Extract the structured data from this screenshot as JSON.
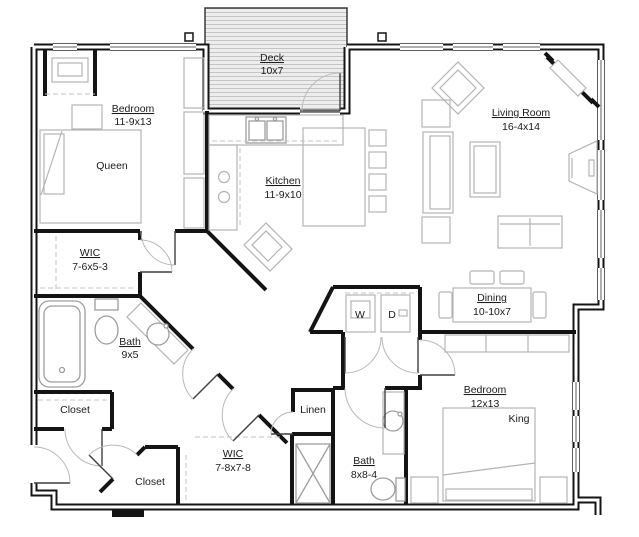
{
  "plan": {
    "title": "Two bedroom apartment floor plan",
    "colors": {
      "wall": "#141414",
      "furniture": "#b3b3b3",
      "fixture": "#9d9d9d",
      "deck_fill": "#ededed",
      "deck_line": "#c4c4c4",
      "text": "#1b1b1b"
    },
    "rooms": {
      "deck": {
        "name": "Deck",
        "dims": "10x7"
      },
      "bedroom1": {
        "name": "Bedroom",
        "dims": "11-9x13",
        "bed": "Queen"
      },
      "living": {
        "name": "Living Room",
        "dims": "16-4x14"
      },
      "kitchen": {
        "name": "Kitchen",
        "dims": "11-9x10"
      },
      "wic1": {
        "name": "WIC",
        "dims": "7-6x5-3"
      },
      "bath1": {
        "name": "Bath",
        "dims": "9x5"
      },
      "closet1": {
        "name": "Closet"
      },
      "laundry": {
        "washer": "W",
        "dryer": "D"
      },
      "dining": {
        "name": "Dining",
        "dims": "10-10x7"
      },
      "bedroom2": {
        "name": "Bedroom",
        "dims": "12x13",
        "bed": "King"
      },
      "linen": {
        "name": "Linen"
      },
      "wic2": {
        "name": "WIC",
        "dims": "7-8x7-8"
      },
      "bath2": {
        "name": "Bath",
        "dims": "8x8-4"
      },
      "closet2": {
        "name": "Closet"
      }
    }
  }
}
